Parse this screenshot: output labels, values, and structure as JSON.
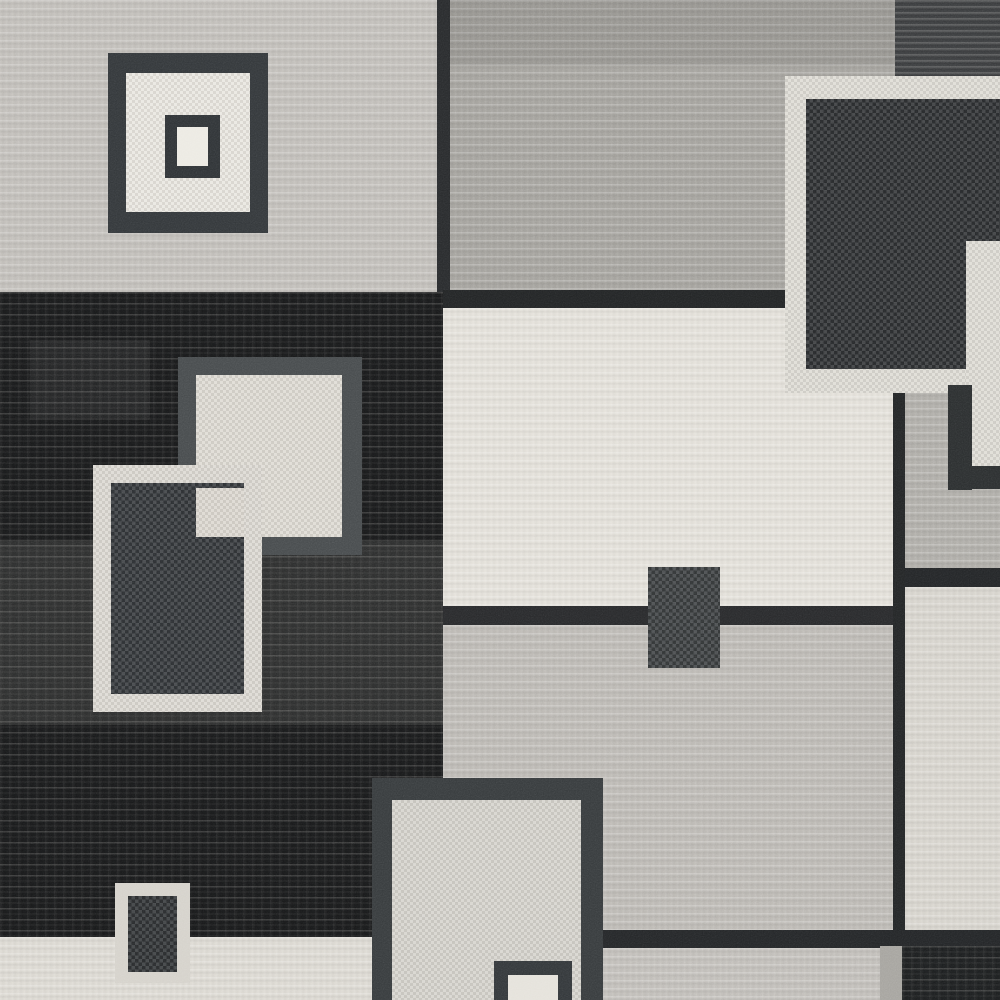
{
  "description": "Close-up photograph of a modern geometric area rug with overlapping color-block squares and rectangles in charcoal black, medium gray, light gray and cream wool pile",
  "palette": {
    "light_gray_field": "#c3c0bb",
    "medium_gray_field": "#a6a49f",
    "center_cream_field": "#e5e2db",
    "center_gray_field": "#bebbb6",
    "black_field": "#191a1b",
    "charcoal_square": "#2c2f31",
    "cream_frame": "#dbd8d1",
    "dark_frame": "#33373a"
  },
  "scene": {
    "width": 1000,
    "height": 1000,
    "shapes": [
      {
        "name": "field-top-left-lightgray",
        "x": 0,
        "y": 0,
        "w": 445,
        "h": 296,
        "color": "#c3c0bb",
        "tex": "stria-light"
      },
      {
        "name": "field-top-middle-gray",
        "x": 443,
        "y": 0,
        "w": 452,
        "h": 296,
        "color": "#a6a49f",
        "tex": "stria-light"
      },
      {
        "name": "shade-top-middle",
        "x": 443,
        "y": 0,
        "w": 452,
        "h": 65,
        "color": "rgba(0,0,0,0.08)"
      },
      {
        "name": "block-top-right-charcoal",
        "x": 895,
        "y": 0,
        "w": 105,
        "h": 80,
        "color": "#3d3f41",
        "tex": "stria-dark"
      },
      {
        "name": "seam-vertical-top",
        "x": 437,
        "y": 0,
        "w": 13,
        "h": 300,
        "color": "#282a2c"
      },
      {
        "name": "field-black-left",
        "x": 0,
        "y": 292,
        "w": 445,
        "h": 648,
        "color": "#191a1b",
        "tex": "stria-black"
      },
      {
        "name": "wash-black-field-light-1",
        "x": 0,
        "y": 540,
        "w": 443,
        "h": 185,
        "color": "rgba(225,223,218,0.10)"
      },
      {
        "name": "wash-black-field-light-2",
        "x": 30,
        "y": 340,
        "w": 120,
        "h": 80,
        "color": "rgba(225,223,218,0.06)"
      },
      {
        "name": "seam-horizontal-center-top",
        "x": 443,
        "y": 290,
        "w": 345,
        "h": 18,
        "color": "#222425"
      },
      {
        "name": "field-center-cream",
        "x": 443,
        "y": 308,
        "w": 452,
        "h": 302,
        "color": "#e5e2db",
        "tex": "stria-light"
      },
      {
        "name": "seam-horizontal-center-mid",
        "x": 443,
        "y": 606,
        "w": 452,
        "h": 19,
        "color": "#28292b"
      },
      {
        "name": "field-center-gray",
        "x": 443,
        "y": 625,
        "w": 452,
        "h": 308,
        "color": "#bebbb6",
        "tex": "stria-light"
      },
      {
        "name": "seam-horizontal-center-bottom",
        "x": 598,
        "y": 930,
        "w": 300,
        "h": 18,
        "color": "#242628"
      },
      {
        "name": "band-bottom-gray",
        "x": 600,
        "y": 948,
        "w": 295,
        "h": 52,
        "color": "#c3c0bb",
        "tex": "stria-light"
      },
      {
        "name": "field-bottom-left-cream",
        "x": 0,
        "y": 937,
        "w": 374,
        "h": 63,
        "color": "#dedbd4",
        "tex": "stria-light"
      },
      {
        "name": "field-right-gray",
        "x": 903,
        "y": 392,
        "w": 97,
        "h": 180,
        "color": "#b1afaa",
        "tex": "stria-light"
      },
      {
        "name": "seam-horizontal-right",
        "x": 895,
        "y": 568,
        "w": 105,
        "h": 19,
        "color": "#232527"
      },
      {
        "name": "field-right-cream",
        "x": 903,
        "y": 587,
        "w": 97,
        "h": 345,
        "color": "#d9d6cf",
        "tex": "stria-light"
      },
      {
        "name": "seam-vertical-right",
        "x": 893,
        "y": 392,
        "w": 12,
        "h": 540,
        "color": "#232526"
      },
      {
        "name": "seam-horizontal-bottom-right",
        "x": 880,
        "y": 930,
        "w": 120,
        "h": 17,
        "color": "#232527"
      },
      {
        "name": "block-bottom-right-black",
        "x": 902,
        "y": 946,
        "w": 98,
        "h": 54,
        "color": "#1d1f20",
        "tex": "stria-black"
      },
      {
        "name": "sliver-bottom-right-gray",
        "x": 880,
        "y": 946,
        "w": 22,
        "h": 54,
        "color": "#a6a49f"
      },
      {
        "name": "big-square-cream-frame",
        "x": 785,
        "y": 76,
        "w": 215,
        "h": 317,
        "color": "#dbd8d1",
        "tex": "pebble-light"
      },
      {
        "name": "big-square-charcoal-fill",
        "x": 806,
        "y": 99,
        "w": 162,
        "h": 270,
        "color": "#2c2f31",
        "tex": "pebble"
      },
      {
        "name": "big-square-charcoal-extension",
        "x": 968,
        "y": 99,
        "w": 32,
        "h": 142,
        "color": "#2c2f31",
        "tex": "pebble"
      },
      {
        "name": "corner-cream-right",
        "x": 966,
        "y": 241,
        "w": 34,
        "h": 227,
        "color": "#dbd8d1",
        "tex": "pebble-light"
      },
      {
        "name": "dark-elbow-vertical",
        "x": 948,
        "y": 385,
        "w": 24,
        "h": 105,
        "color": "#2b2e2f"
      },
      {
        "name": "dark-elbow-horizontal",
        "x": 948,
        "y": 466,
        "w": 52,
        "h": 23,
        "color": "#2b2e2f"
      },
      {
        "name": "nested-square-outer-frame",
        "x": 108,
        "y": 53,
        "w": 160,
        "h": 180,
        "color": "#33373a"
      },
      {
        "name": "nested-square-outer-fill",
        "x": 126,
        "y": 73,
        "w": 124,
        "h": 139,
        "color": "#e7e4dd",
        "tex": "pebble-light"
      },
      {
        "name": "nested-square-inner-frame",
        "x": 165,
        "y": 115,
        "w": 55,
        "h": 63,
        "color": "#2f3336"
      },
      {
        "name": "nested-square-inner-fill",
        "x": 177,
        "y": 127,
        "w": 31,
        "h": 39,
        "color": "#eceae3"
      },
      {
        "name": "light-square-gray-frame",
        "x": 178,
        "y": 357,
        "w": 184,
        "h": 198,
        "color": "#474b4d"
      },
      {
        "name": "light-square-cream-fill",
        "x": 196,
        "y": 375,
        "w": 146,
        "h": 162,
        "color": "#dbd7cf",
        "tex": "pebble-light"
      },
      {
        "name": "white-frame-rect-border",
        "x": 93,
        "y": 465,
        "w": 169,
        "h": 247,
        "color": "#d8d5ce",
        "tex": "pebble-light"
      },
      {
        "name": "white-frame-rect-interior",
        "x": 111,
        "y": 483,
        "w": 133,
        "h": 211,
        "color": "#323639",
        "tex": "pebble"
      },
      {
        "name": "overlap-cream-patch",
        "x": 196,
        "y": 488,
        "w": 48,
        "h": 49,
        "color": "#d8d4cc",
        "tex": "pebble-light"
      },
      {
        "name": "small-rect-cream-frame",
        "x": 115,
        "y": 883,
        "w": 75,
        "h": 100,
        "color": "#d5d2cb"
      },
      {
        "name": "small-rect-charcoal-fill",
        "x": 128,
        "y": 896,
        "w": 49,
        "h": 76,
        "color": "#2e3133",
        "tex": "pebble"
      },
      {
        "name": "center-small-charcoal-rect",
        "x": 648,
        "y": 567,
        "w": 72,
        "h": 101,
        "color": "#393c3e",
        "tex": "pebble"
      },
      {
        "name": "bottom-rect-dark-frame",
        "x": 372,
        "y": 778,
        "w": 231,
        "h": 222,
        "color": "#373b3d"
      },
      {
        "name": "bottom-rect-light-fill",
        "x": 392,
        "y": 800,
        "w": 189,
        "h": 200,
        "color": "#d2cfc8",
        "tex": "pebble-light"
      },
      {
        "name": "bottom-rect-inner-frame",
        "x": 494,
        "y": 961,
        "w": 78,
        "h": 39,
        "color": "#33373a"
      },
      {
        "name": "bottom-rect-inner-white-fill",
        "x": 508,
        "y": 975,
        "w": 50,
        "h": 25,
        "color": "#e5e2db"
      }
    ]
  }
}
